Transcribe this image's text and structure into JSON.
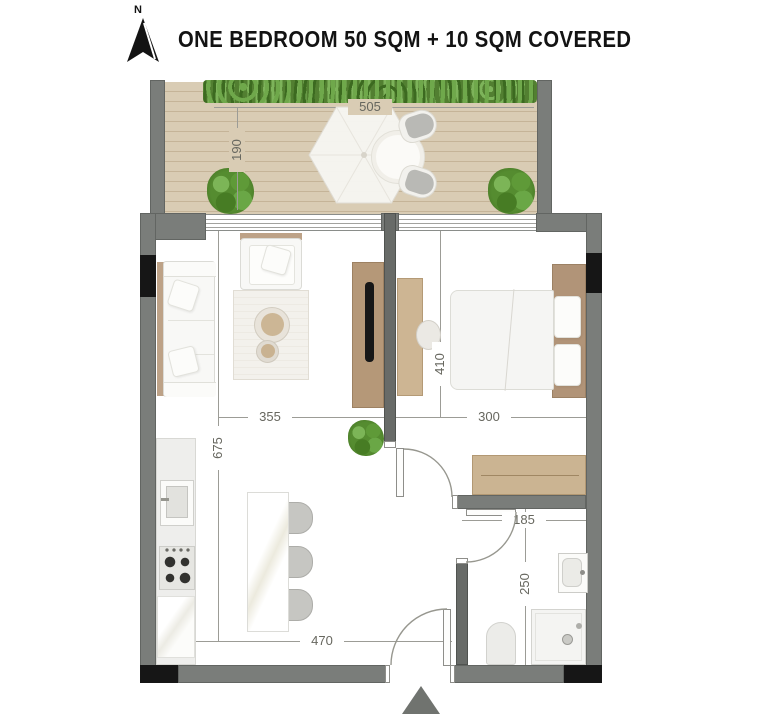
{
  "header": {
    "north_label": "N",
    "title": "ONE BEDROOM 50 SQM + 10 SQM COVERED"
  },
  "dimensions": {
    "balcony_width": "505",
    "balcony_depth": "190",
    "living_width": "355",
    "living_depth": "675",
    "bedroom_depth": "410",
    "bedroom_width": "300",
    "bathroom_width": "185",
    "bathroom_depth": "250",
    "lower_width": "470"
  },
  "colors": {
    "wall": "#7a7d7a",
    "structural_black": "#161616",
    "deck_wood": "#d9ccb4",
    "furniture_wood": "#c6ae8d",
    "plant_green": "#55862f",
    "dimension_text": "#67675f"
  }
}
